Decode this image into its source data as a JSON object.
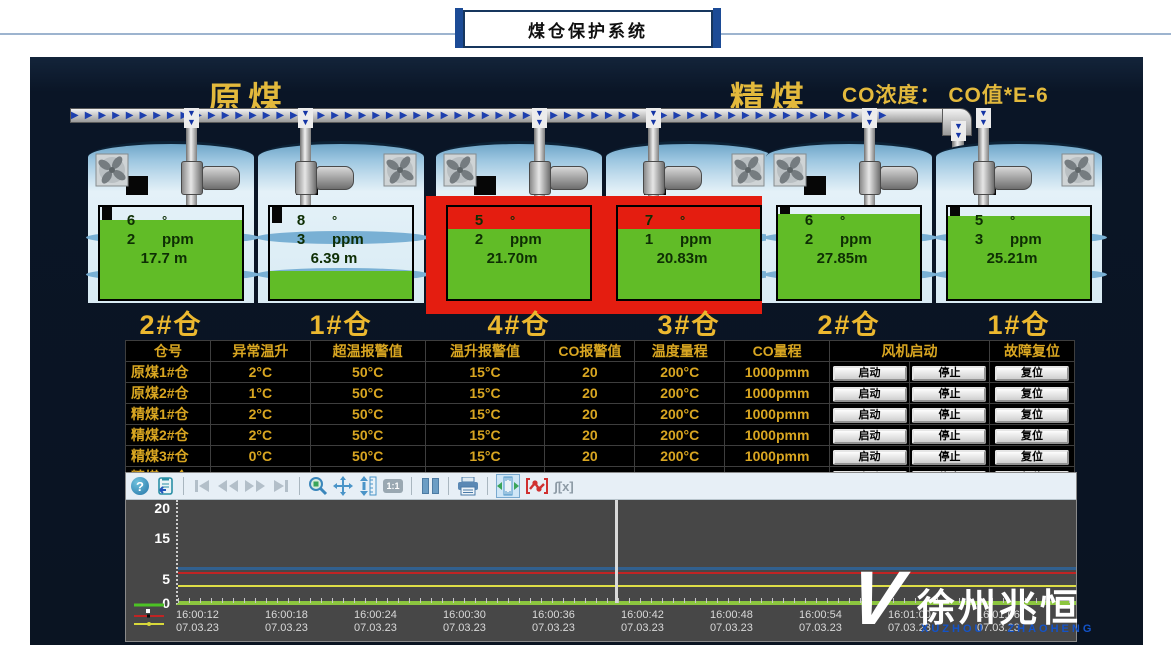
{
  "window": {
    "title": "煤仓保护系统"
  },
  "header": {
    "raw_coal_label": "原煤",
    "clean_coal_label": "精煤",
    "co_note": "CO浓度： CO值*E-6"
  },
  "tank_units": {
    "temp_unit": "°",
    "co_unit": "ppm"
  },
  "tanks": [
    {
      "label": "2#仓",
      "group": "原煤",
      "temp": "6",
      "co": "2",
      "level": "17.7 m",
      "fill_pct": 86,
      "alarm": false
    },
    {
      "label": "1#仓",
      "group": "原煤",
      "temp": "8",
      "co": "3",
      "level": "6.39 m",
      "fill_pct": 30,
      "alarm": false
    },
    {
      "label": "4#仓",
      "group": "精煤",
      "temp": "5",
      "co": "2",
      "level": "21.70m",
      "fill_pct": 76,
      "alarm": true
    },
    {
      "label": "3#仓",
      "group": "精煤",
      "temp": "7",
      "co": "1",
      "level": "20.83m",
      "fill_pct": 76,
      "alarm": true
    },
    {
      "label": "2#仓",
      "group": "精煤",
      "temp": "6",
      "co": "2",
      "level": "27.85m",
      "fill_pct": 92,
      "alarm": false
    },
    {
      "label": "1#仓",
      "group": "精煤",
      "temp": "5",
      "co": "3",
      "level": "25.21m",
      "fill_pct": 90,
      "alarm": false
    }
  ],
  "table": {
    "headers": {
      "bin": "仓号",
      "rise": "异常温升",
      "over": "超温报警值",
      "rise_alarm": "温升报警值",
      "co_alarm": "CO报警值",
      "temp_range": "温度量程",
      "co_range": "CO量程",
      "fan": "风机启动",
      "fault_reset": "故障复位"
    },
    "rows": [
      {
        "name": "原煤1#仓",
        "rise": "2°C",
        "over": "50°C",
        "rise_alarm": "15°C",
        "co_alarm": "20",
        "temp_range": "200°C",
        "co_range": "1000pmm"
      },
      {
        "name": "原煤2#仓",
        "rise": "1°C",
        "over": "50°C",
        "rise_alarm": "15°C",
        "co_alarm": "20",
        "temp_range": "200°C",
        "co_range": "1000pmm"
      },
      {
        "name": "精煤1#仓",
        "rise": "2°C",
        "over": "50°C",
        "rise_alarm": "15°C",
        "co_alarm": "20",
        "temp_range": "200°C",
        "co_range": "1000pmm"
      },
      {
        "name": "精煤2#仓",
        "rise": "2°C",
        "over": "50°C",
        "rise_alarm": "15°C",
        "co_alarm": "20",
        "temp_range": "200°C",
        "co_range": "1000pmm"
      },
      {
        "name": "精煤3#仓",
        "rise": "0°C",
        "over": "50°C",
        "rise_alarm": "15°C",
        "co_alarm": "20",
        "temp_range": "200°C",
        "co_range": "1000pmm"
      },
      {
        "name": "精煤4#仓",
        "rise": "1°C",
        "over": "50°C",
        "rise_alarm": "15°C",
        "co_alarm": "20",
        "temp_range": "200°C",
        "co_range": "1000pmm"
      }
    ],
    "fan_start_label": "启动",
    "fan_stop_label": "停止",
    "reset_label": "复位"
  },
  "toolbar": {
    "one_to_one": "1:1",
    "integral": "∫[x]"
  },
  "chart_data": {
    "type": "line",
    "title": "",
    "y_max": 20,
    "y_ticks": [
      "20",
      "15",
      "5",
      "0"
    ],
    "x_labels": [
      "16:00:12",
      "16:00:18",
      "16:00:24",
      "16:00:30",
      "16:00:36",
      "16:00:42",
      "16:00:48",
      "16:00:54",
      "16:01:00",
      "16:01:06"
    ],
    "date": "07.03.23",
    "series": [
      {
        "name": "pen-blue",
        "color": "#31608f",
        "value": 7
      },
      {
        "name": "pen-red",
        "color": "#c02424",
        "value": 6
      },
      {
        "name": "pen-yellow",
        "color": "#dede46",
        "value": 3.5
      },
      {
        "name": "pen-green",
        "color": "#8cc63f",
        "value": 0.3
      }
    ],
    "legend_position": "bottom-left",
    "grid": false
  },
  "decor": {
    "arrow": "▶",
    "down_arrow": "▼"
  },
  "watermark": {
    "logo": "V",
    "cn": "徐州兆恒",
    "en_left": "XUZHOU",
    "en_right": "ZHAOHENG"
  }
}
